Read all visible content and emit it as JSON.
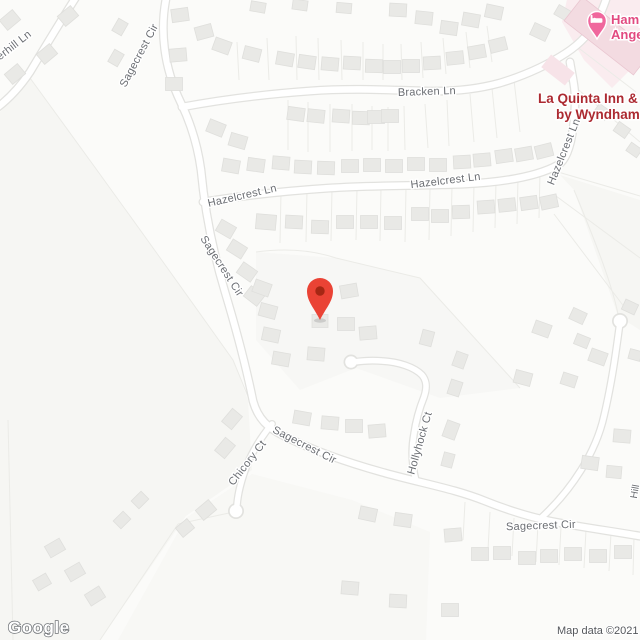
{
  "map": {
    "street_labels": {
      "erhill": "erhill Ln",
      "sagecrest_top": "Sagecrest Cir",
      "bracken": "Bracken Ln",
      "hazelcrest_w": "Hazelcrest Ln",
      "hazelcrest_e": "Hazelcrest Ln",
      "hazelcrest_v": "Hazelcrest Ln",
      "sagecrest_mid": "Sagecrest Cir",
      "chicory": "Chicory Ct",
      "sagecrest_low": "Sagecrest Cir",
      "hollyhock": "Hollyhock Ct",
      "sagecrest_se": "Sagecrest Cir",
      "edge_partial": "Hill"
    },
    "pois": {
      "hampton": {
        "line1": "Hamp",
        "line2": "Ange"
      },
      "la_quinta": {
        "line1": "La Quinta Inn & S",
        "line2": "by Wyndham S"
      }
    },
    "footer": {
      "logo": "Google",
      "attribution": "Map data ©2021"
    },
    "colors": {
      "marker_red": "#EA4335",
      "marker_red_dark": "#A52714",
      "lodging_pin": "#F0679D",
      "lodging_text": "#E24A80",
      "la_quinta_text": "#AC2A31",
      "street_label": "#6B6E73",
      "attribution_text": "#54575B"
    }
  }
}
